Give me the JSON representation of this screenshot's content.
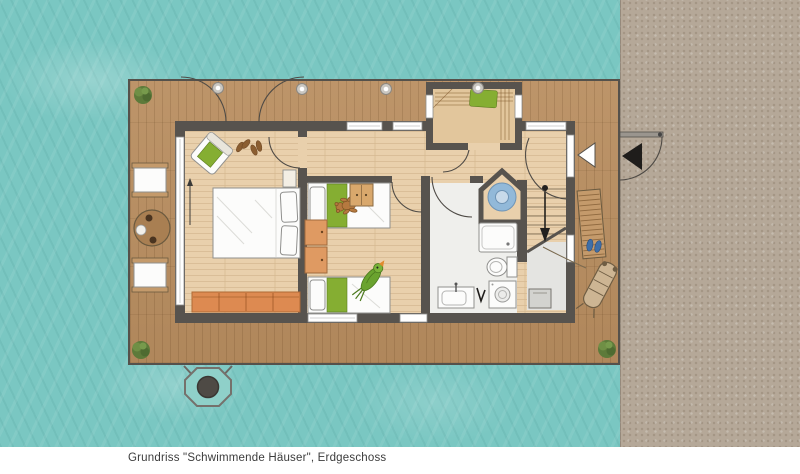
{
  "caption": "Grundriss \"Schwimmende Häuser\", Erdgeschoss",
  "colors": {
    "water": "#7ac7c2",
    "sand": "#b5a898",
    "deck": "#b98e60",
    "wall": "#57534e",
    "floor": "#e9d0ac",
    "bath": "#efefec",
    "storage": "#e4e4e1",
    "bench": "#e2c69c",
    "green": "#85ae32",
    "orange": "#dd8a51",
    "shower": "#92b9d9",
    "text": "#3c3c3c"
  }
}
